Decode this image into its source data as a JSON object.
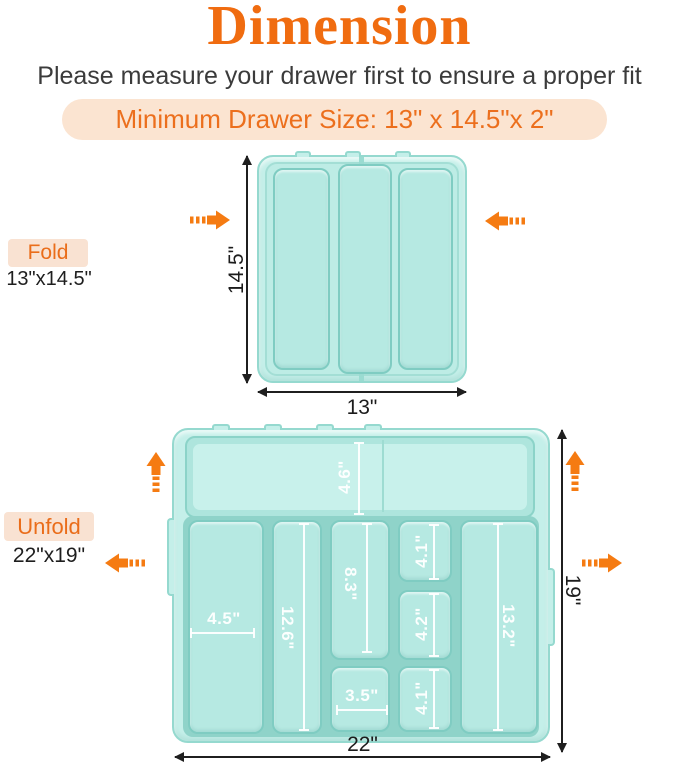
{
  "header": {
    "title": "Dimension",
    "subtitle": "Please measure your drawer first to ensure a proper fit",
    "min_drawer_size": "Minimum Drawer Size: 13\" x 14.5\"x 2\""
  },
  "fold": {
    "label": "Fold",
    "size": "13\"x14.5\"",
    "height": "14.5\"",
    "width": "13\""
  },
  "unfold": {
    "label": "Unfold",
    "size": "22\"x19\"",
    "width": "22\"",
    "height": "19\"",
    "dims": {
      "top": "4.6\"",
      "col1": "4.5\"",
      "col2": "12.6\"",
      "col3_top": "8.3\"",
      "col3_bottom": "3.5\"",
      "col4_top": "4.1\"",
      "col4_middle": "4.2\"",
      "col4_bottom": "4.1\"",
      "col5": "13.2\""
    }
  },
  "colors": {
    "accent_orange": "#f06c10",
    "arrow_orange": "#f57b12",
    "peach_bg": "#fbe4d1",
    "tray_mint": "#c4efe9",
    "tray_border": "#95d9cf",
    "compartment_fill": "#b6e9e2",
    "compartment_border": "#7fccc2",
    "dimension_line": "#1f1f1f"
  }
}
